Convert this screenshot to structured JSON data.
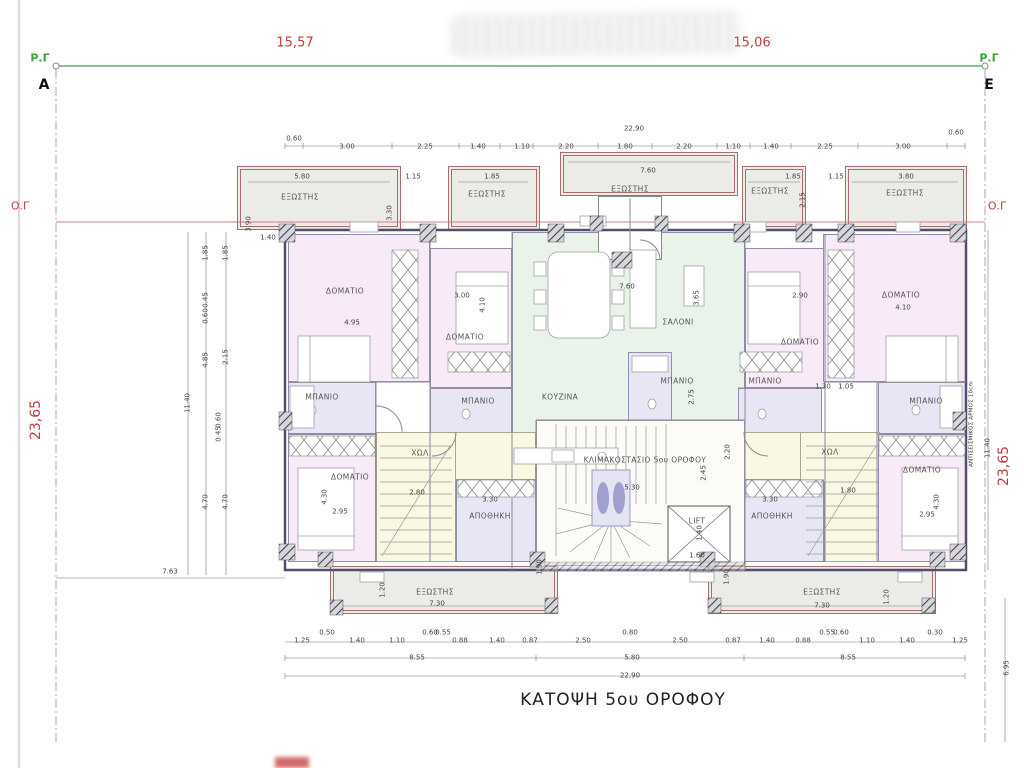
{
  "title": "ΚΑΤΟΨΗ 5ου ΟΡΟΦΟΥ",
  "colors": {
    "boundary_green": "#3aa33a",
    "dimension_red": "#c23b3b",
    "balcony_fill": "#ebebe8",
    "bedroom_fill": "#f8eaf7",
    "bath_fill": "#e8e6f5",
    "living_fill": "#e9f3ea",
    "hall_fill": "#faf7e3",
    "storage_fill": "#e6e6f5",
    "wall_color": "#50506e"
  },
  "plan": {
    "rooms": [
      {
        "x": 237,
        "y": 166,
        "w": 164,
        "h": 64,
        "f": "balcony",
        "n": "balcony-top-left"
      },
      {
        "x": 448,
        "y": 166,
        "w": 92,
        "h": 64,
        "f": "balcony",
        "n": "balcony-top-left-center"
      },
      {
        "x": 560,
        "y": 152,
        "w": 178,
        "h": 44,
        "f": "balcony",
        "n": "balcony-top-center"
      },
      {
        "x": 742,
        "y": 166,
        "w": 64,
        "h": 64,
        "f": "balcony",
        "n": "balcony-top-right-center"
      },
      {
        "x": 845,
        "y": 166,
        "w": 122,
        "h": 64,
        "f": "balcony",
        "n": "balcony-top-right"
      },
      {
        "x": 330,
        "y": 566,
        "w": 228,
        "h": 48,
        "f": "balcony",
        "n": "balcony-bottom-left"
      },
      {
        "x": 708,
        "y": 566,
        "w": 228,
        "h": 48,
        "f": "balcony",
        "n": "balcony-bottom-right"
      },
      {
        "x": 288,
        "y": 234,
        "w": 142,
        "h": 148,
        "f": "bed",
        "n": "bedroom-top-left"
      },
      {
        "x": 430,
        "y": 248,
        "w": 82,
        "h": 140,
        "f": "bed",
        "n": "bedroom-center-left"
      },
      {
        "x": 512,
        "y": 232,
        "w": 233,
        "h": 210,
        "f": "living",
        "n": "living-room"
      },
      {
        "x": 745,
        "y": 248,
        "w": 80,
        "h": 140,
        "f": "bed",
        "n": "bedroom-center-right"
      },
      {
        "x": 823,
        "y": 234,
        "w": 143,
        "h": 148,
        "f": "bed",
        "n": "bedroom-top-right"
      },
      {
        "x": 288,
        "y": 382,
        "w": 88,
        "h": 52,
        "f": "bath",
        "n": "bath-left"
      },
      {
        "x": 430,
        "y": 388,
        "w": 82,
        "h": 52,
        "f": "bath",
        "n": "bath-center-left"
      },
      {
        "x": 628,
        "y": 352,
        "w": 44,
        "h": 86,
        "f": "bath",
        "n": "bath-center"
      },
      {
        "x": 738,
        "y": 388,
        "w": 84,
        "h": 52,
        "f": "bath",
        "n": "bath-center-right"
      },
      {
        "x": 878,
        "y": 382,
        "w": 88,
        "h": 52,
        "f": "bath",
        "n": "bath-right"
      },
      {
        "x": 376,
        "y": 432,
        "w": 160,
        "h": 48,
        "f": "hall",
        "n": "hall-left-strip"
      },
      {
        "x": 376,
        "y": 432,
        "w": 80,
        "h": 130,
        "f": "hall",
        "n": "hall-left"
      },
      {
        "x": 744,
        "y": 432,
        "w": 136,
        "h": 48,
        "f": "hall",
        "n": "hall-right-strip"
      },
      {
        "x": 800,
        "y": 432,
        "w": 80,
        "h": 130,
        "f": "hall",
        "n": "hall-right"
      },
      {
        "x": 288,
        "y": 434,
        "w": 88,
        "h": 128,
        "f": "bed",
        "n": "bedroom-bottom-left"
      },
      {
        "x": 878,
        "y": 434,
        "w": 88,
        "h": 128,
        "f": "bed",
        "n": "bedroom-bottom-right"
      },
      {
        "x": 536,
        "y": 420,
        "w": 209,
        "h": 146,
        "f": "stair",
        "n": "stairwell"
      },
      {
        "x": 456,
        "y": 480,
        "w": 80,
        "h": 82,
        "f": "store",
        "n": "storage-left"
      },
      {
        "x": 744,
        "y": 480,
        "w": 80,
        "h": 82,
        "f": "store",
        "n": "storage-right"
      },
      {
        "x": 598,
        "y": 196,
        "w": 64,
        "h": 64,
        "f": "entry",
        "n": "entry-structure"
      }
    ],
    "annotations": [
      {
        "t": "Ρ.Γ",
        "x": 40,
        "y": 58,
        "c": "green",
        "n": "boundary-point-label-left"
      },
      {
        "t": "Ρ.Γ",
        "x": 989,
        "y": 58,
        "c": "green",
        "n": "boundary-point-label-right"
      },
      {
        "t": "Α",
        "x": 44,
        "y": 85,
        "c": "corner",
        "n": "corner-label-a"
      },
      {
        "t": "Ε",
        "x": 989,
        "y": 85,
        "c": "corner",
        "n": "corner-label-e"
      },
      {
        "t": "15,57",
        "x": 295,
        "y": 43,
        "c": "red",
        "n": "boundary-dim-left"
      },
      {
        "t": "15,06",
        "x": 752,
        "y": 43,
        "c": "red",
        "n": "boundary-dim-right"
      },
      {
        "t": "Ο.Γ",
        "x": 20,
        "y": 206,
        "c": "red-s",
        "n": "og-label-left"
      },
      {
        "t": "Ο.Γ",
        "x": 997,
        "y": 206,
        "c": "red-s",
        "n": "og-label-right"
      },
      {
        "t": "23,65",
        "x": 36,
        "y": 420,
        "c": "redv",
        "n": "side-dim-left"
      },
      {
        "t": "23,65",
        "x": 1004,
        "y": 466,
        "c": "redv",
        "n": "side-dim-right"
      },
      {
        "t": "ΑΝΤΙΣΕΙΣΜΙΚΟΣ ΑΡΜΟΣ 10cm",
        "x": 972,
        "y": 424,
        "c": "seis",
        "n": "seismic-joint-label"
      },
      {
        "t": "11.40",
        "x": 988,
        "y": 448,
        "c": "dimv"
      },
      {
        "t": "6.95",
        "x": 1007,
        "y": 668,
        "c": "dimv"
      },
      {
        "t": "ΕΞΩΣΤΗΣ",
        "x": 300,
        "y": 197,
        "c": "room-l"
      },
      {
        "t": "ΕΞΩΣΤΗΣ",
        "x": 487,
        "y": 194,
        "c": "room-l"
      },
      {
        "t": "ΕΞΩΣΤΗΣ",
        "x": 630,
        "y": 189,
        "c": "room-l"
      },
      {
        "t": "ΕΞΩΣΤΗΣ",
        "x": 770,
        "y": 191,
        "c": "room-l"
      },
      {
        "t": "ΕΞΩΣΤΗΣ",
        "x": 905,
        "y": 193,
        "c": "room-l"
      },
      {
        "t": "ΕΞΩΣΤΗΣ",
        "x": 435,
        "y": 592,
        "c": "room-l"
      },
      {
        "t": "ΕΞΩΣΤΗΣ",
        "x": 822,
        "y": 592,
        "c": "room-l"
      },
      {
        "t": "ΔΟΜΑΤΙΟ",
        "x": 345,
        "y": 291,
        "c": "room-l"
      },
      {
        "t": "ΔΟΜΑΤΙΟ",
        "x": 465,
        "y": 337,
        "c": "room-l"
      },
      {
        "t": "ΔΟΜΑΤΙΟ",
        "x": 800,
        "y": 342,
        "c": "room-l"
      },
      {
        "t": "ΔΟΜΑΤΙΟ",
        "x": 901,
        "y": 295,
        "c": "room-l"
      },
      {
        "t": "ΔΟΜΑΤΙΟ",
        "x": 350,
        "y": 477,
        "c": "room-l"
      },
      {
        "t": "ΔΟΜΑΤΙΟ",
        "x": 922,
        "y": 470,
        "c": "room-l"
      },
      {
        "t": "ΜΠΑΝΙΟ",
        "x": 322,
        "y": 397,
        "c": "room-l"
      },
      {
        "t": "ΜΠΑΝΙΟ",
        "x": 478,
        "y": 401,
        "c": "room-l"
      },
      {
        "t": "ΜΠΑΝΙΟ",
        "x": 677,
        "y": 381,
        "c": "room-l"
      },
      {
        "t": "ΜΠΑΝΙΟ",
        "x": 765,
        "y": 381,
        "c": "room-l"
      },
      {
        "t": "ΜΠΑΝΙΟ",
        "x": 926,
        "y": 401,
        "c": "room-l"
      },
      {
        "t": "ΣΑΛΟΝΙ",
        "x": 678,
        "y": 322,
        "c": "room-l"
      },
      {
        "t": "ΚΟΥΖΙΝΑ",
        "x": 560,
        "y": 397,
        "c": "room-l"
      },
      {
        "t": "ΧΩΛ",
        "x": 420,
        "y": 453,
        "c": "room-l"
      },
      {
        "t": "ΧΩΛ",
        "x": 830,
        "y": 452,
        "c": "room-l"
      },
      {
        "t": "ΑΠΟΘΗΚΗ",
        "x": 490,
        "y": 516,
        "c": "room-l"
      },
      {
        "t": "ΑΠΟΘΗΚΗ",
        "x": 772,
        "y": 516,
        "c": "room-l"
      },
      {
        "t": "ΚΛΙΜΑΚΟΣΤΑΣΙΟ 5ου ΟΡΟΦΟΥ",
        "x": 645,
        "y": 460,
        "c": "room-l"
      },
      {
        "t": "LIFT",
        "x": 697,
        "y": 521,
        "c": "room-l"
      },
      {
        "t": "22,90",
        "x": 634,
        "y": 129,
        "c": "dim"
      },
      {
        "t": "0.60",
        "x": 294,
        "y": 139,
        "c": "dim"
      },
      {
        "t": "3.00",
        "x": 347,
        "y": 147,
        "c": "dim"
      },
      {
        "t": "2.25",
        "x": 425,
        "y": 147,
        "c": "dim"
      },
      {
        "t": "1.40",
        "x": 478,
        "y": 147,
        "c": "dim"
      },
      {
        "t": "1.10",
        "x": 522,
        "y": 147,
        "c": "dim"
      },
      {
        "t": "2.20",
        "x": 566,
        "y": 147,
        "c": "dim"
      },
      {
        "t": "1.80",
        "x": 625,
        "y": 147,
        "c": "dim"
      },
      {
        "t": "2.20",
        "x": 684,
        "y": 147,
        "c": "dim"
      },
      {
        "t": "1.10",
        "x": 733,
        "y": 147,
        "c": "dim"
      },
      {
        "t": "1.40",
        "x": 771,
        "y": 147,
        "c": "dim"
      },
      {
        "t": "2.25",
        "x": 825,
        "y": 147,
        "c": "dim"
      },
      {
        "t": "3.00",
        "x": 903,
        "y": 147,
        "c": "dim"
      },
      {
        "t": "0.60",
        "x": 956,
        "y": 133,
        "c": "dim"
      },
      {
        "t": "5.80",
        "x": 302,
        "y": 177,
        "c": "dim"
      },
      {
        "t": "1.15",
        "x": 413,
        "y": 177,
        "c": "dim"
      },
      {
        "t": "1.85",
        "x": 492,
        "y": 177,
        "c": "dim"
      },
      {
        "t": "7.60",
        "x": 648,
        "y": 171,
        "c": "dim"
      },
      {
        "t": "1.85",
        "x": 793,
        "y": 177,
        "c": "dim"
      },
      {
        "t": "1.15",
        "x": 836,
        "y": 177,
        "c": "dim"
      },
      {
        "t": "3.80",
        "x": 906,
        "y": 177,
        "c": "dim"
      },
      {
        "t": "3.30",
        "x": 390,
        "y": 213,
        "c": "dimv"
      },
      {
        "t": "3.90",
        "x": 249,
        "y": 224,
        "c": "dimv"
      },
      {
        "t": "2.15",
        "x": 803,
        "y": 200,
        "c": "dimv"
      },
      {
        "t": "1.40",
        "x": 268,
        "y": 238,
        "c": "dim"
      },
      {
        "t": "4.95",
        "x": 352,
        "y": 323,
        "c": "dim"
      },
      {
        "t": "3.00",
        "x": 462,
        "y": 296,
        "c": "dim"
      },
      {
        "t": "4.10",
        "x": 483,
        "y": 305,
        "c": "dimv"
      },
      {
        "t": "7.60",
        "x": 627,
        "y": 287,
        "c": "dim"
      },
      {
        "t": "3.65",
        "x": 697,
        "y": 298,
        "c": "dimv"
      },
      {
        "t": "2.90",
        "x": 800,
        "y": 296,
        "c": "dim"
      },
      {
        "t": "4.10",
        "x": 903,
        "y": 308,
        "c": "dim"
      },
      {
        "t": "1.30",
        "x": 823,
        "y": 387,
        "c": "dim"
      },
      {
        "t": "1.05",
        "x": 846,
        "y": 387,
        "c": "dim"
      },
      {
        "t": "2.75",
        "x": 692,
        "y": 397,
        "c": "dimv"
      },
      {
        "t": "2.80",
        "x": 417,
        "y": 493,
        "c": "dim"
      },
      {
        "t": "1.80",
        "x": 848,
        "y": 491,
        "c": "dim"
      },
      {
        "t": "3.30",
        "x": 490,
        "y": 500,
        "c": "dim"
      },
      {
        "t": "3.30",
        "x": 770,
        "y": 500,
        "c": "dim"
      },
      {
        "t": "5.30",
        "x": 632,
        "y": 488,
        "c": "dim"
      },
      {
        "t": "2.45",
        "x": 704,
        "y": 473,
        "c": "dimv"
      },
      {
        "t": "2.20",
        "x": 728,
        "y": 452,
        "c": "dimv"
      },
      {
        "t": "1.40",
        "x": 700,
        "y": 533,
        "c": "dimv"
      },
      {
        "t": "1.60",
        "x": 697,
        "y": 556,
        "c": "dim"
      },
      {
        "t": "2.95",
        "x": 340,
        "y": 512,
        "c": "dim"
      },
      {
        "t": "4.30",
        "x": 325,
        "y": 497,
        "c": "dimv"
      },
      {
        "t": "2.95",
        "x": 927,
        "y": 515,
        "c": "dim"
      },
      {
        "t": "4.30",
        "x": 937,
        "y": 502,
        "c": "dimv"
      },
      {
        "t": "1.90",
        "x": 540,
        "y": 567,
        "c": "dimv"
      },
      {
        "t": "1.90",
        "x": 727,
        "y": 577,
        "c": "dimv"
      },
      {
        "t": "1.20",
        "x": 383,
        "y": 590,
        "c": "dimv"
      },
      {
        "t": "1.20",
        "x": 887,
        "y": 597,
        "c": "dimv"
      },
      {
        "t": "7.30",
        "x": 437,
        "y": 604,
        "c": "dim"
      },
      {
        "t": "7.30",
        "x": 822,
        "y": 606,
        "c": "dim"
      },
      {
        "t": "11.40",
        "x": 188,
        "y": 403,
        "c": "dimv"
      },
      {
        "t": "1.85",
        "x": 206,
        "y": 253,
        "c": "dimv"
      },
      {
        "t": "1.85",
        "x": 226,
        "y": 253,
        "c": "dimv"
      },
      {
        "t": "0.45",
        "x": 206,
        "y": 300,
        "c": "dimv"
      },
      {
        "t": "0.60",
        "x": 206,
        "y": 316,
        "c": "dimv"
      },
      {
        "t": "4.85",
        "x": 206,
        "y": 360,
        "c": "dimv"
      },
      {
        "t": "2.15",
        "x": 226,
        "y": 357,
        "c": "dimv"
      },
      {
        "t": "0.60",
        "x": 219,
        "y": 420,
        "c": "dimv"
      },
      {
        "t": "0.45",
        "x": 219,
        "y": 434,
        "c": "dimv"
      },
      {
        "t": "4.70",
        "x": 206,
        "y": 502,
        "c": "dimv"
      },
      {
        "t": "4.70",
        "x": 226,
        "y": 502,
        "c": "dimv"
      },
      {
        "t": "7.63",
        "x": 170,
        "y": 572,
        "c": "dim"
      },
      {
        "t": "1.25",
        "x": 302,
        "y": 641,
        "c": "dim"
      },
      {
        "t": "0.50",
        "x": 327,
        "y": 633,
        "c": "dim"
      },
      {
        "t": "1.40",
        "x": 357,
        "y": 641,
        "c": "dim"
      },
      {
        "t": "1.10",
        "x": 397,
        "y": 641,
        "c": "dim"
      },
      {
        "t": "0.60",
        "x": 430,
        "y": 633,
        "c": "dim"
      },
      {
        "t": "0.55",
        "x": 443,
        "y": 633,
        "c": "dim"
      },
      {
        "t": "0.88",
        "x": 460,
        "y": 641,
        "c": "dim"
      },
      {
        "t": "1.40",
        "x": 497,
        "y": 641,
        "c": "dim"
      },
      {
        "t": "0.87",
        "x": 530,
        "y": 641,
        "c": "dim"
      },
      {
        "t": "2.50",
        "x": 583,
        "y": 641,
        "c": "dim"
      },
      {
        "t": "0.80",
        "x": 630,
        "y": 633,
        "c": "dim"
      },
      {
        "t": "2.50",
        "x": 680,
        "y": 641,
        "c": "dim"
      },
      {
        "t": "0.87",
        "x": 733,
        "y": 641,
        "c": "dim"
      },
      {
        "t": "1.40",
        "x": 767,
        "y": 641,
        "c": "dim"
      },
      {
        "t": "0.88",
        "x": 803,
        "y": 641,
        "c": "dim"
      },
      {
        "t": "0.55",
        "x": 827,
        "y": 633,
        "c": "dim"
      },
      {
        "t": "0.60",
        "x": 841,
        "y": 633,
        "c": "dim"
      },
      {
        "t": "1.10",
        "x": 867,
        "y": 641,
        "c": "dim"
      },
      {
        "t": "1.40",
        "x": 907,
        "y": 641,
        "c": "dim"
      },
      {
        "t": "0.30",
        "x": 935,
        "y": 633,
        "c": "dim"
      },
      {
        "t": "1.25",
        "x": 960,
        "y": 641,
        "c": "dim"
      },
      {
        "t": "8.55",
        "x": 417,
        "y": 658,
        "c": "dim"
      },
      {
        "t": "5.80",
        "x": 632,
        "y": 658,
        "c": "dim"
      },
      {
        "t": "8.55",
        "x": 848,
        "y": 658,
        "c": "dim"
      },
      {
        "t": "22,90",
        "x": 630,
        "y": 676,
        "c": "dim"
      }
    ]
  }
}
